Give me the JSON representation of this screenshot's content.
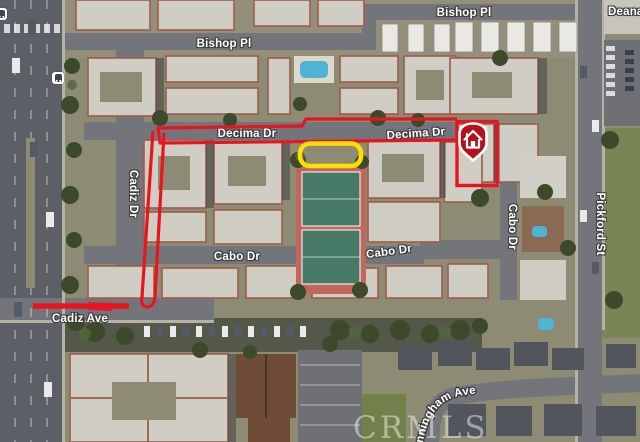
{
  "map": {
    "street_labels": {
      "bishop_pl": "Bishop Pl",
      "deana": "Deana",
      "decima_dr": "Decima Dr",
      "cadiz_dr": "Cadiz Dr",
      "cabo_dr": "Cabo Dr",
      "cadiz_ave": "Cadiz Ave",
      "pickford_st": "Pickford St",
      "cunningham_ave": "Cunningham Ave"
    },
    "watermark": "CRMLS",
    "pin": {
      "registered_mark": "®"
    },
    "annotation_colors": {
      "route_red": "#ea1420",
      "highlight_yellow": "#ffdf00",
      "pin_red": "#b5121c",
      "pin_white": "#ffffff"
    }
  }
}
